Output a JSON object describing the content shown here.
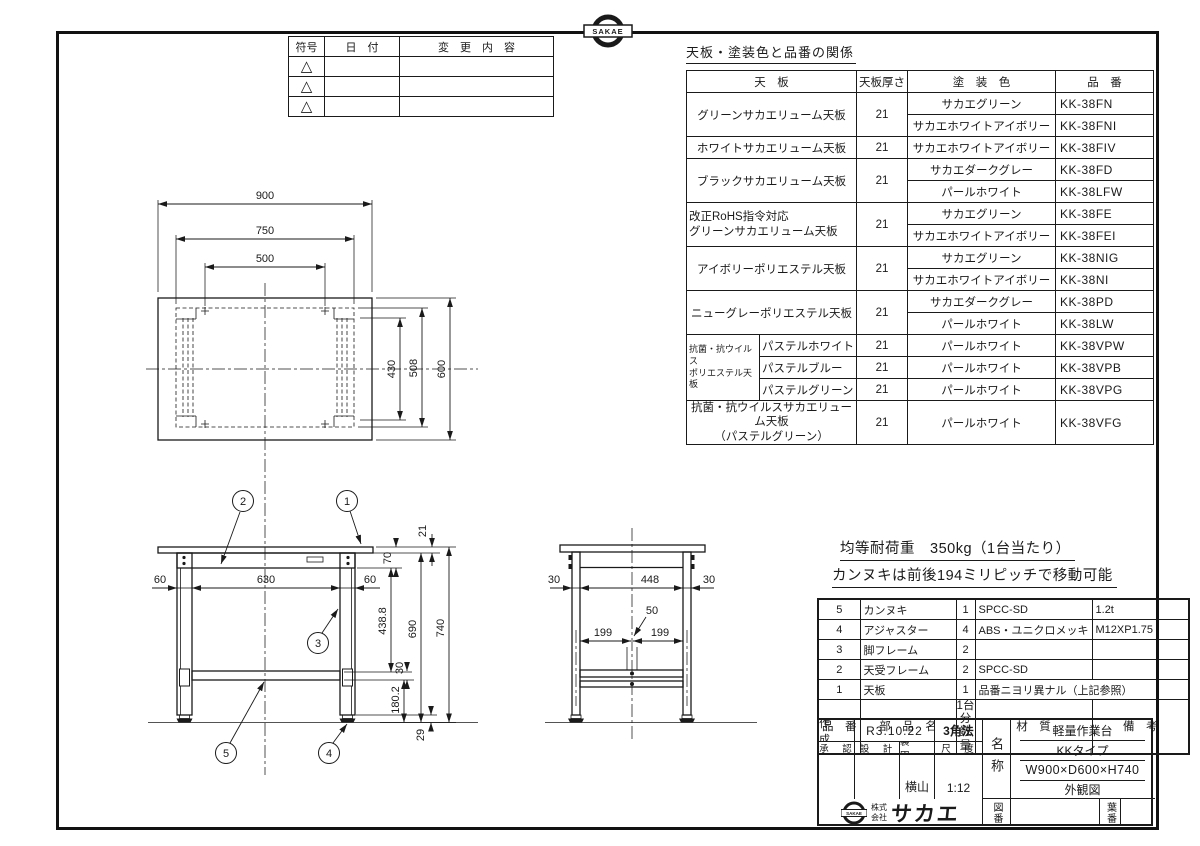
{
  "sheet": {
    "ink": "#1a1a1a",
    "paper": "#ffffff"
  },
  "stamp": {
    "emblem_text": "SAKAE"
  },
  "revision_table": {
    "col_symbol": "符号",
    "col_date": "日　付",
    "col_change": "変　更　内　容",
    "symbol": "△"
  },
  "paint_table": {
    "title": "天板・塗装色と品番の関係",
    "col_board": "天　板",
    "col_thickness": "天板厚さ",
    "col_color": "塗　装　色",
    "col_part": "品　番",
    "g1": {
      "board": "グリーンサカエリューム天板",
      "t": "21",
      "c1": "サカエグリーン",
      "p1": "KK-38FN",
      "c2": "サカエホワイトアイボリー",
      "p2": "KK-38FNI"
    },
    "g2": {
      "board": "ホワイトサカエリューム天板",
      "t": "21",
      "c1": "サカエホワイトアイボリー",
      "p1": "KK-38FIV"
    },
    "g3": {
      "board": "ブラックサカエリューム天板",
      "t": "21",
      "c1": "サカエダークグレー",
      "p1": "KK-38FD",
      "c2": "パールホワイト",
      "p2": "KK-38LFW"
    },
    "g4": {
      "board": "改正RoHS指令対応\nグリーンサカエリューム天板",
      "t": "21",
      "c1": "サカエグリーン",
      "p1": "KK-38FE",
      "c2": "サカエホワイトアイボリー",
      "p2": "KK-38FEI"
    },
    "g5": {
      "board": "アイボリーポリエステル天板",
      "t": "21",
      "c1": "サカエグリーン",
      "p1": "KK-38NIG",
      "c2": "サカエホワイトアイボリー",
      "p2": "KK-38NI"
    },
    "g6": {
      "board": "ニューグレーポリエステル天板",
      "t": "21",
      "c1": "サカエダークグレー",
      "p1": "KK-38PD",
      "c2": "パールホワイト",
      "p2": "KK-38LW"
    },
    "g7": {
      "group": "抗菌・抗ウイルス\nポリエステル天板",
      "v1": {
        "board": "パステルホワイト",
        "t": "21",
        "c": "パールホワイト",
        "p": "KK-38VPW"
      },
      "v2": {
        "board": "パステルブルー",
        "t": "21",
        "c": "パールホワイト",
        "p": "KK-38VPB"
      },
      "v3": {
        "board": "パステルグリーン",
        "t": "21",
        "c": "パールホワイト",
        "p": "KK-38VPG"
      }
    },
    "g8": {
      "board": "抗菌・抗ウイルスサカエリューム天板\n（パステルグリーン）",
      "t": "21",
      "c1": "パールホワイト",
      "p1": "KK-38VFG"
    }
  },
  "top_view": {
    "d900": "900",
    "d750": "750",
    "d500": "500",
    "d430": "430",
    "d508": "508",
    "d600": "600"
  },
  "front_view": {
    "d21": "21",
    "d70": "70",
    "d60l": "60",
    "d630": "630",
    "d60r": "60",
    "d438": "438.8",
    "d690": "690",
    "d740": "740",
    "d30": "30",
    "d180": "180.2",
    "d29": "29",
    "balloons": {
      "b1": "1",
      "b2": "2",
      "b3": "3",
      "b4": "4",
      "b5": "5"
    }
  },
  "side_view": {
    "d30l": "30",
    "d448": "448",
    "d30r": "30",
    "d50": "50",
    "d199l": "199",
    "d199r": "199"
  },
  "notes": {
    "line1": "均等耐荷重　350kg（1台当たり）",
    "line2": "カンヌキは前後194ミリピッチで移動可能"
  },
  "parts_table": {
    "col_no": "品　番",
    "col_name": "部　品　名",
    "col_qty": "1台分\n数量",
    "col_material": "材　質",
    "col_remarks": "備　考",
    "rows": [
      {
        "no": "5",
        "name": "カンヌキ",
        "qty": "1",
        "material": "SPCC-SD",
        "remarks": "1.2t"
      },
      {
        "no": "4",
        "name": "アジャスター",
        "qty": "4",
        "material": "ABS・ユニクロメッキ",
        "remarks": "M12XP1.75"
      },
      {
        "no": "3",
        "name": "脚フレーム",
        "qty": "2",
        "material": "",
        "remarks": ""
      },
      {
        "no": "2",
        "name": "天受フレーム",
        "qty": "2",
        "material": "SPCC-SD",
        "remarks": ""
      },
      {
        "no": "1",
        "name": "天板",
        "qty": "1",
        "material": "品番ニヨリ異ナル（上記参照）",
        "remarks": ""
      }
    ]
  },
  "title_block": {
    "created_label": "作　成",
    "created_value": "R3.10.22",
    "projection": "3角法",
    "approved_label": "承　認",
    "design_label": "設　計",
    "draft_label": "製　図",
    "scale_label": "尺　度",
    "draft_value": "横山",
    "scale_value": "1:12",
    "name_label": "名称",
    "product_name": "軽量作業台",
    "product_type": "KKタイプ",
    "product_size": "W900×D600×H740",
    "view_type": "外観図",
    "drawing_no_label": "図番",
    "sheet_no_label": "葉番",
    "company_prefix": "株式\n会社",
    "company_name": "サカエ",
    "company_emblem": "SAKAE"
  }
}
